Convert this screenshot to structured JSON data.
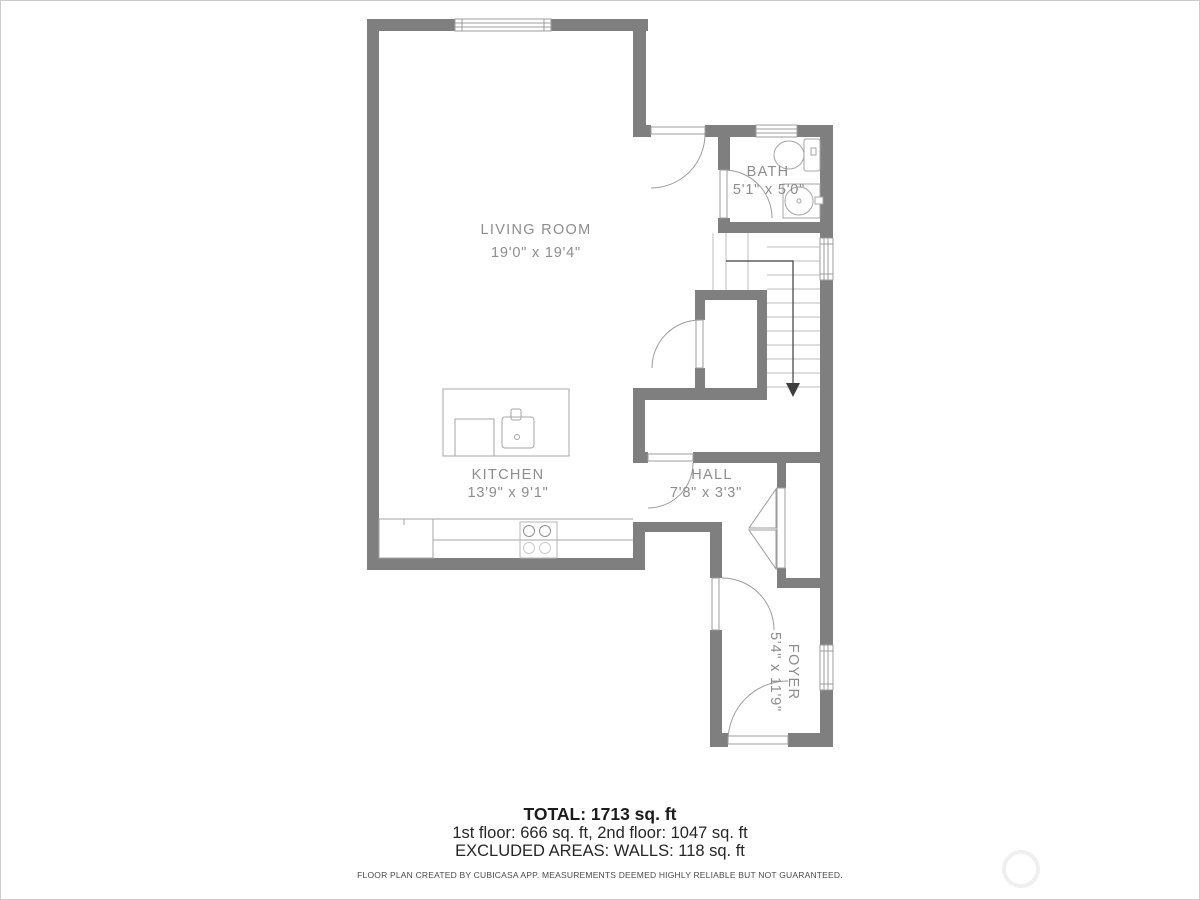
{
  "plan": {
    "rooms": {
      "living": {
        "name": "LIVING ROOM",
        "dims": "19'0\" x 19'4\""
      },
      "kitchen": {
        "name": "KITCHEN",
        "dims": "13'9\" x 9'1\""
      },
      "bath": {
        "name": "BATH",
        "dims": "5'1\" x 5'0\""
      },
      "hall": {
        "name": "HALL",
        "dims": "7'8\" x 3'3\""
      },
      "foyer": {
        "name": "FOYER",
        "dims": "5'4\" x 11'9\""
      }
    },
    "colors": {
      "wall": "#7f7f7f",
      "door_window_outline": "#9c9c9c",
      "fixture_outline": "#a6a6a6",
      "stair_line": "#bcbcbc",
      "arrow": "#3e3e3e",
      "label": "#8d8d8d"
    }
  },
  "summary": {
    "total": "TOTAL: 1713 sq. ft",
    "floors": "1st floor: 666 sq. ft, 2nd floor: 1047 sq. ft",
    "excluded": "EXCLUDED AREAS: WALLS: 118 sq. ft"
  },
  "disclaimer": "FLOOR PLAN CREATED BY CUBICASA APP. MEASUREMENTS DEEMED HIGHLY RELIABLE BUT NOT GUARANTEED."
}
